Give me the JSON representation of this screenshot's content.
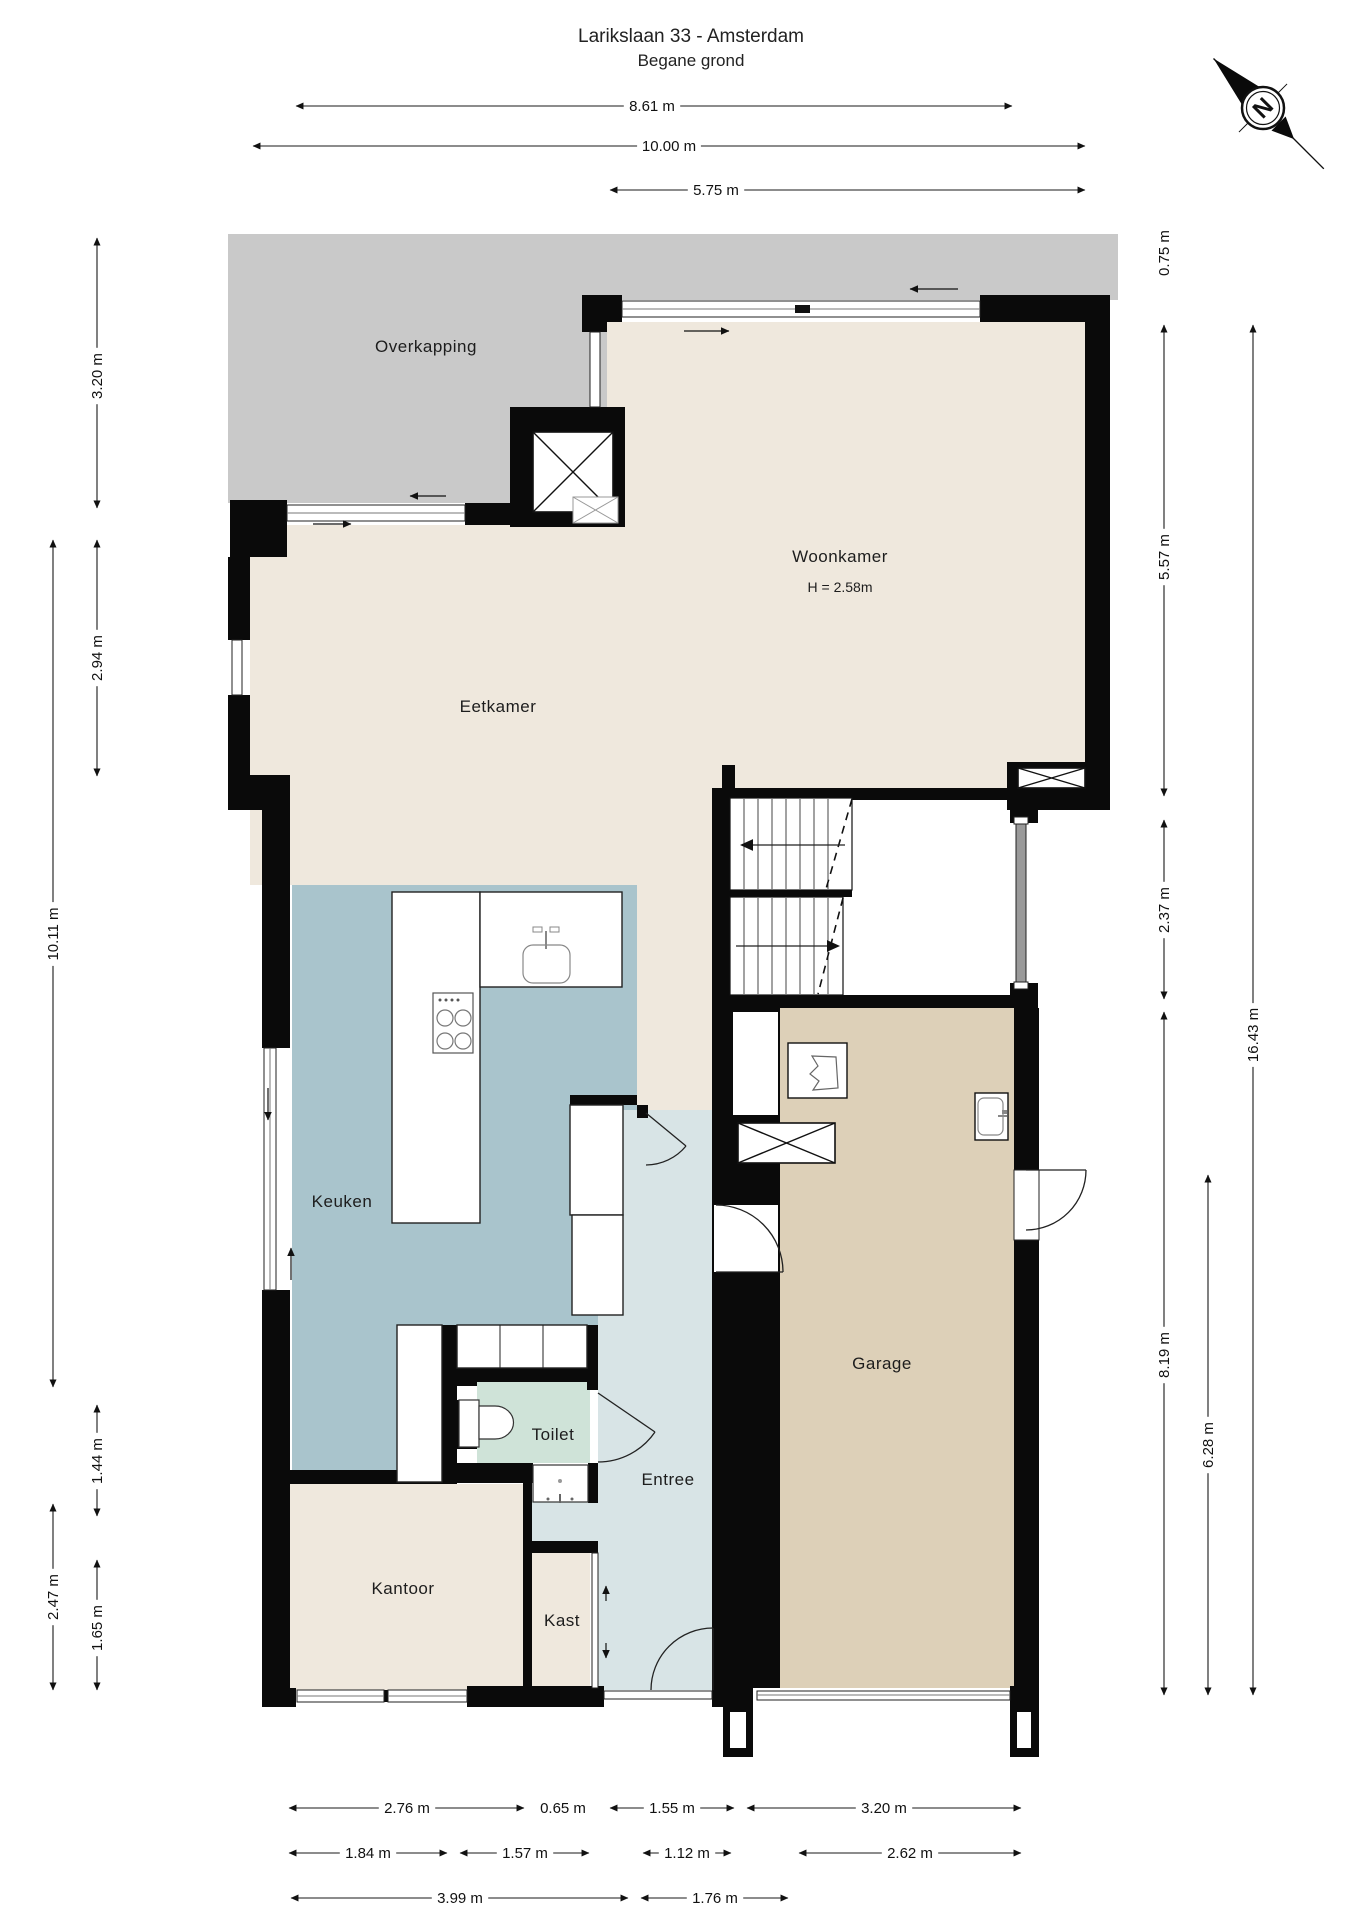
{
  "title": {
    "line1": "Larikslaan 33 - Amsterdam",
    "line2": "Begane grond"
  },
  "compass": {
    "label": "N"
  },
  "colors": {
    "wall": "#0a0a0a",
    "overkapping": "#c9c9c9",
    "living": "#efe8dd",
    "kitchen": "#a9c4cc",
    "entree": "#d8e4e6",
    "toilet": "#cfe3d8",
    "garage": "#ddd0b8",
    "stairwell": "#ffffff"
  },
  "rooms": [
    {
      "id": "overkapping",
      "label": "Overkapping",
      "x": 426,
      "y": 352
    },
    {
      "id": "woonkamer",
      "label": "Woonkamer",
      "x": 840,
      "y": 562
    },
    {
      "id": "woonkamer-height",
      "label": "H = 2.58m",
      "x": 840,
      "y": 592,
      "small": true
    },
    {
      "id": "eetkamer",
      "label": "Eetkamer",
      "x": 498,
      "y": 712
    },
    {
      "id": "keuken",
      "label": "Keuken",
      "x": 342,
      "y": 1207
    },
    {
      "id": "toilet",
      "label": "Toilet",
      "x": 553,
      "y": 1440
    },
    {
      "id": "entree",
      "label": "Entree",
      "x": 668,
      "y": 1485
    },
    {
      "id": "garage",
      "label": "Garage",
      "x": 882,
      "y": 1369
    },
    {
      "id": "kantoor",
      "label": "Kantoor",
      "x": 403,
      "y": 1594
    },
    {
      "id": "kast",
      "label": "Kast",
      "x": 562,
      "y": 1626
    }
  ],
  "dimensions": [
    {
      "label": "8.61 m",
      "vertical": false,
      "x1": 296,
      "x2": 1012,
      "y": 106,
      "lx": 652,
      "ly": 106
    },
    {
      "label": "10.00 m",
      "vertical": false,
      "x1": 253,
      "x2": 1085,
      "y": 146,
      "lx": 669,
      "ly": 146
    },
    {
      "label": "5.75 m",
      "vertical": false,
      "x1": 610,
      "x2": 1085,
      "y": 190,
      "lx": 716,
      "ly": 190
    },
    {
      "label": "3.20 m",
      "vertical": true,
      "x": 97,
      "y1": 238,
      "y2": 508,
      "lx": 97,
      "ly": 376
    },
    {
      "label": "2.94 m",
      "vertical": true,
      "x": 97,
      "y1": 540,
      "y2": 776,
      "lx": 97,
      "ly": 658
    },
    {
      "label": "10.11 m",
      "vertical": true,
      "x": 53,
      "y1": 540,
      "y2": 1387,
      "lx": 53,
      "ly": 934
    },
    {
      "label": "1.44 m",
      "vertical": true,
      "x": 97,
      "y1": 1405,
      "y2": 1516,
      "lx": 97,
      "ly": 1461
    },
    {
      "label": "2.47 m",
      "vertical": true,
      "x": 53,
      "y1": 1504,
      "y2": 1690,
      "lx": 53,
      "ly": 1597
    },
    {
      "label": "1.65 m",
      "vertical": true,
      "x": 97,
      "y1": 1560,
      "y2": 1690,
      "lx": 97,
      "ly": 1628
    },
    {
      "label": "0.75 m",
      "vertical": true,
      "line": false,
      "lx": 1164,
      "ly": 253
    },
    {
      "label": "5.57 m",
      "vertical": true,
      "x": 1164,
      "y1": 325,
      "y2": 796,
      "lx": 1164,
      "ly": 557
    },
    {
      "label": "2.37 m",
      "vertical": true,
      "x": 1164,
      "y1": 820,
      "y2": 999,
      "lx": 1164,
      "ly": 910
    },
    {
      "label": "8.19 m",
      "vertical": true,
      "x": 1164,
      "y1": 1012,
      "y2": 1695,
      "lx": 1164,
      "ly": 1355
    },
    {
      "label": "6.28 m",
      "vertical": true,
      "x": 1208,
      "y1": 1175,
      "y2": 1695,
      "lx": 1208,
      "ly": 1445
    },
    {
      "label": "16.43 m",
      "vertical": true,
      "x": 1253,
      "y1": 325,
      "y2": 1695,
      "lx": 1253,
      "ly": 1035
    },
    {
      "label": "2.76 m",
      "vertical": false,
      "x1": 289,
      "x2": 524,
      "y": 1808,
      "lx": 407,
      "ly": 1808
    },
    {
      "label": "0.65 m",
      "vertical": false,
      "line": false,
      "lx": 563,
      "ly": 1808
    },
    {
      "label": "1.55 m",
      "vertical": false,
      "x1": 610,
      "x2": 734,
      "y": 1808,
      "lx": 672,
      "ly": 1808
    },
    {
      "label": "3.20 m",
      "vertical": false,
      "x1": 747,
      "x2": 1021,
      "y": 1808,
      "lx": 884,
      "ly": 1808
    },
    {
      "label": "1.84 m",
      "vertical": false,
      "x1": 289,
      "x2": 447,
      "y": 1853,
      "lx": 368,
      "ly": 1853
    },
    {
      "label": "1.57 m",
      "vertical": false,
      "x1": 460,
      "x2": 589,
      "y": 1853,
      "lx": 525,
      "ly": 1853
    },
    {
      "label": "1.12 m",
      "vertical": false,
      "x1": 643,
      "x2": 731,
      "y": 1853,
      "lx": 687,
      "ly": 1853
    },
    {
      "label": "2.62 m",
      "vertical": false,
      "x1": 799,
      "x2": 1021,
      "y": 1853,
      "lx": 910,
      "ly": 1853
    },
    {
      "label": "3.99 m",
      "vertical": false,
      "x1": 291,
      "x2": 628,
      "y": 1898,
      "lx": 460,
      "ly": 1898
    },
    {
      "label": "1.76 m",
      "vertical": false,
      "x1": 641,
      "x2": 788,
      "y": 1898,
      "lx": 715,
      "ly": 1898
    }
  ]
}
